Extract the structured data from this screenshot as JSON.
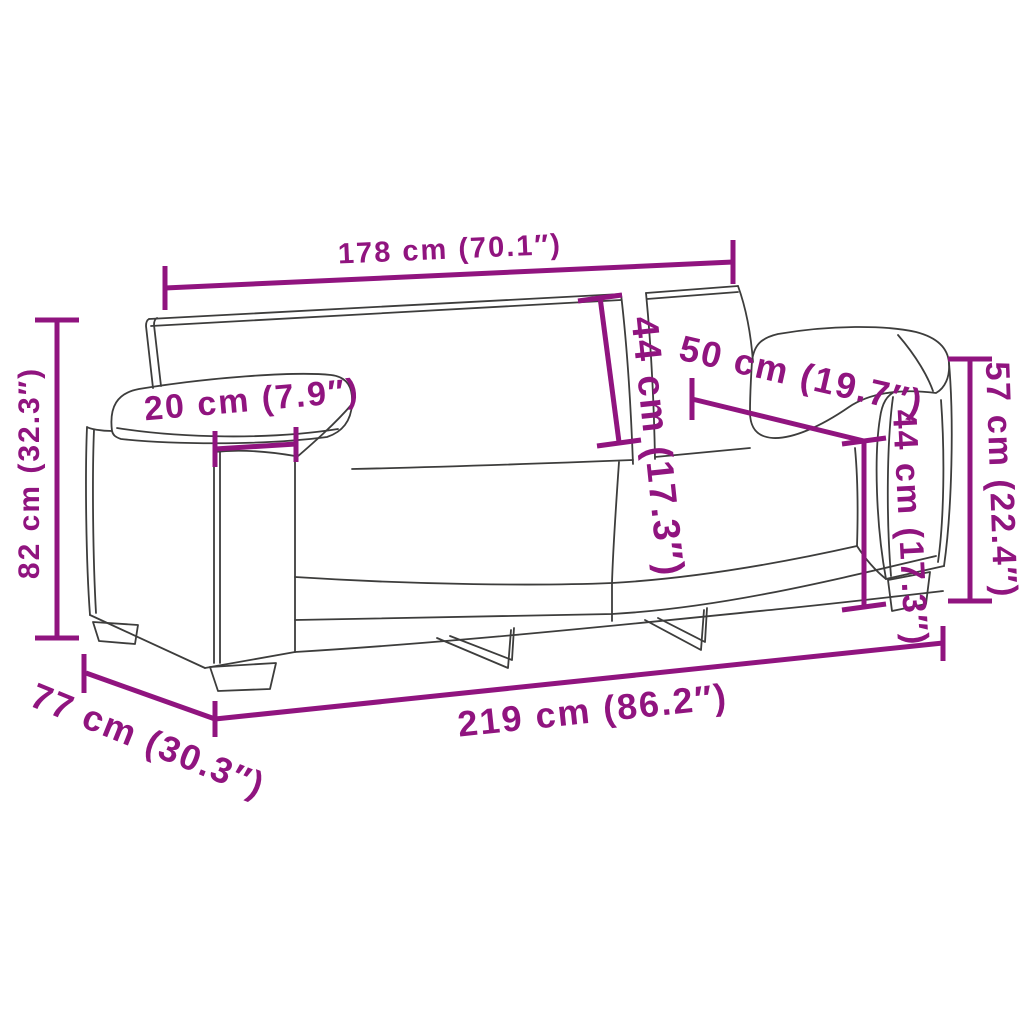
{
  "meta": {
    "title": "Sofa dimension diagram",
    "unit_system": "cm with inch conversion"
  },
  "colors": {
    "dimension_accent": "#90147f",
    "outline": "#3d3d3c",
    "background": "#ffffff"
  },
  "labels": {
    "top_width": "178 cm (70.1″)",
    "left_height": "82 cm (32.3″)",
    "armrest_width": "20 cm (7.9″)",
    "back_cushion_height": "44 cm (17.3″)",
    "armrest_depth": "50 cm (19.7″)",
    "right_arm_height": "57 cm (22.4″)",
    "right_seat_height": "44 cm (17.3″)",
    "bottom_width": "219 cm (86.2″)",
    "depth": "77 cm (30.3″)"
  }
}
